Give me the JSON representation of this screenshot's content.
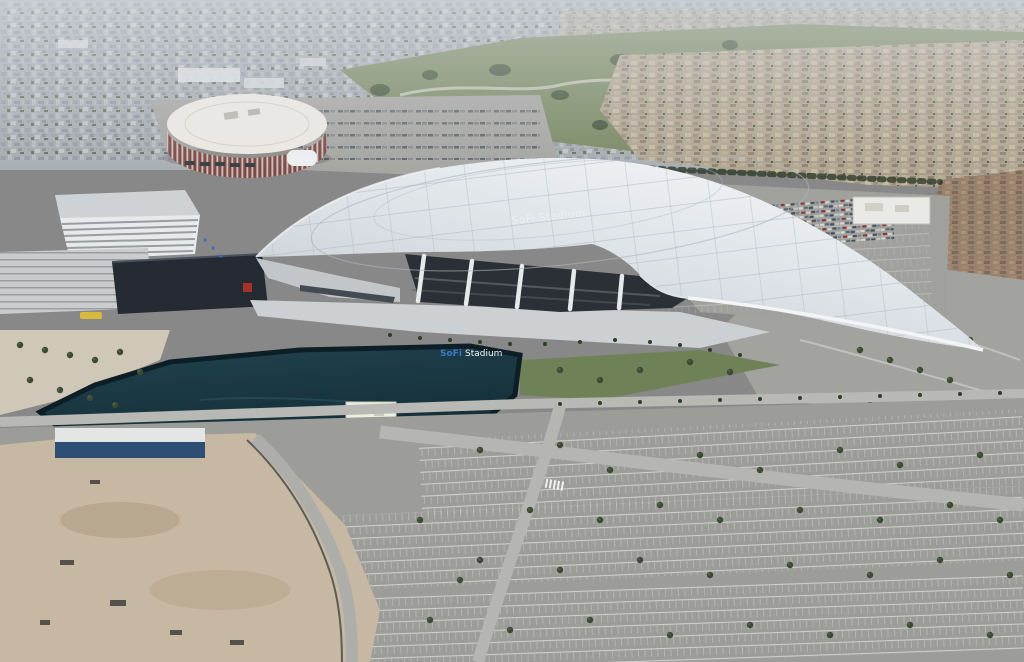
{
  "scene": {
    "description": "Aerial photograph of SoFi Stadium at Hollywood Park, with the round Kia Forum arena, an artificial lake, office buildings, housing tracts and vast empty parking lots",
    "stadium": {
      "roof_text": "SoFi Stadium"
    },
    "lake_sign": {
      "word1": "SoFi",
      "word2": "Stadium"
    }
  },
  "colors": {
    "sky_haze": "#b7bdc4",
    "city": "#a6abb0",
    "park_green": "#7b8a65",
    "tree": "#3c4a34",
    "forum_roof": "#ece9e3",
    "forum_columns": "#7d4a49",
    "office": "#e8e9ea",
    "theater": "#262a33",
    "roof_light": "#e9edf0",
    "roof_shadow": "#bfc5cc",
    "interior": "#2b3036",
    "column_white": "#e6e9ec",
    "lake": "#1a3640",
    "parking_asphalt": "#9c9c99",
    "stall_line": "#ffffff",
    "road": "#b5b5b1",
    "dirt": "#c6b8a2",
    "housing_tan": "#b0a694",
    "housing_red": "#97816f",
    "lawn": "#6f8257"
  }
}
